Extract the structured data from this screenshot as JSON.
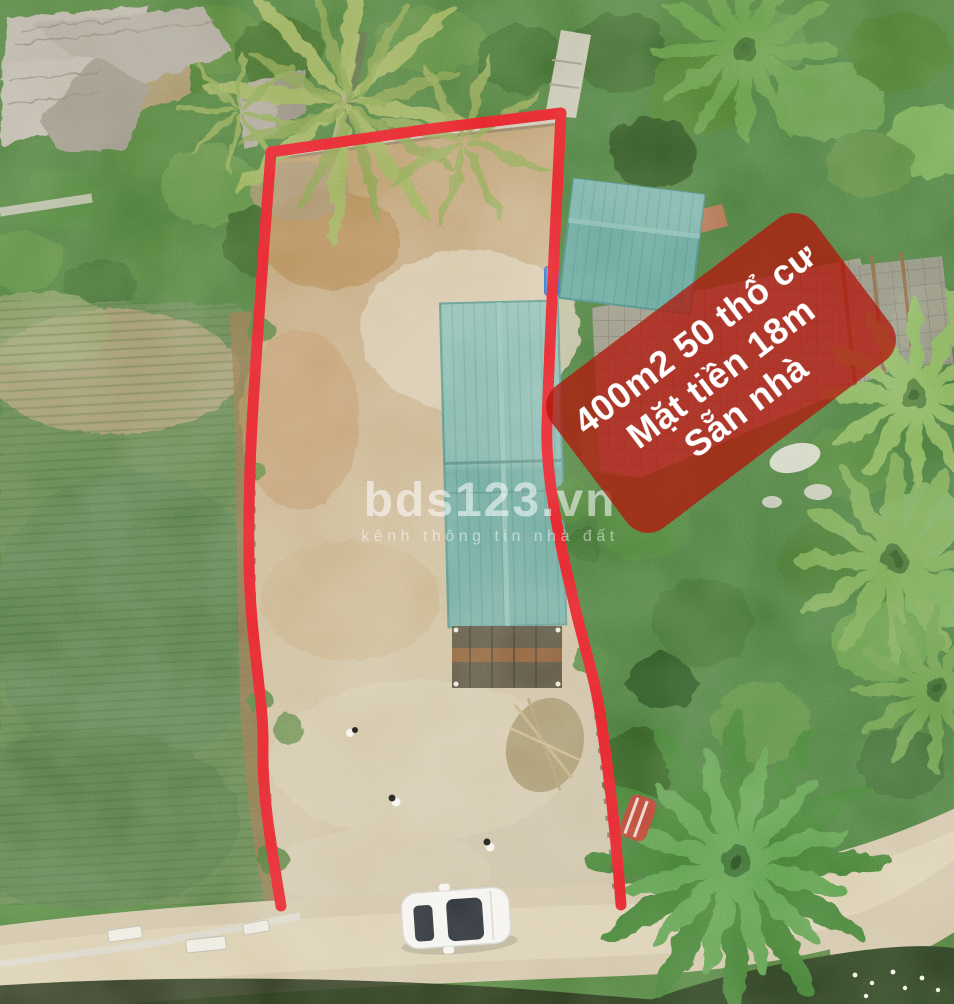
{
  "photo": {
    "kind": "aerial-drone-real-estate-photo",
    "banner": {
      "lines": [
        "400m2 50 thổ cư",
        "Mặt tiền 18m",
        "Sẵn nhà"
      ],
      "bg_color": "#b1150b",
      "text_color": "#ffffff"
    },
    "watermark": {
      "title": "bds123.vn",
      "subtitle": "kênh thông tin nhà đất",
      "color": "#ffffff"
    },
    "colors": {
      "boundary_red": "#e42026",
      "roof_teal": "#74ada1",
      "secondary_roof_teal": "#5e9d92",
      "dirt_plot": "#c2a377",
      "road_tan": "#cdbf9f",
      "crop_field_green": "#5d7c4a",
      "canopy_green": "#4c773a",
      "car_white": "#f4f3ee"
    }
  }
}
